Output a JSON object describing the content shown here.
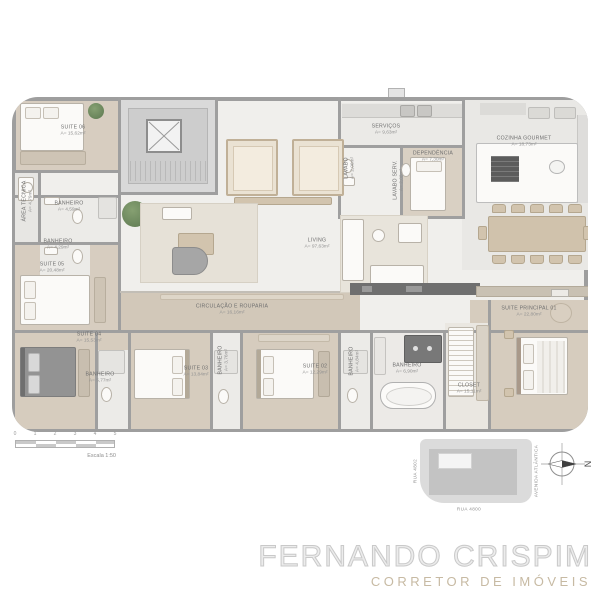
{
  "watermark": {
    "line1": "FERNANDO CRISPIM",
    "line2": "CORRETOR DE IMÓVEIS"
  },
  "scale_bar": {
    "ticks": [
      "0",
      "1",
      "2",
      "3",
      "4",
      "5"
    ],
    "label": "Escala 1:50"
  },
  "compass": {
    "north": "N"
  },
  "site_plan": {
    "street_left": "RUA 4802",
    "street_bottom": "RUA 4800",
    "street_right": "AVENIDA ATLÂNTICA"
  },
  "rooms": {
    "suite06": {
      "name": "SUITE 06",
      "area": "A= 15,62m²"
    },
    "area_tecnica": {
      "name": "ÁREA TÉCNICA",
      "area": "A= 4,79m²"
    },
    "banheiro_suite06": {
      "name": "BANHEIRO",
      "area": "A= 4,59m²"
    },
    "banheiro_suite05": {
      "name": "BANHEIRO",
      "area": "A= 4,29m²"
    },
    "suite05": {
      "name": "SUITE 05",
      "area": "A= 20,48m²"
    },
    "servicos": {
      "name": "SERVIÇOS",
      "area": "A= 9,63m²"
    },
    "lavabo": {
      "name": "LAVABO",
      "area": "A= 2,06m²"
    },
    "lavabo_serv": {
      "name": "LAVABO SERV.",
      "area": "A= 2,08m²"
    },
    "dependencia": {
      "name": "DEPENDÊNCIA",
      "area": "A= 7,30m²"
    },
    "cozinha_gourmet": {
      "name": "COZINHA GOURMET",
      "area": "A= 18,73m²"
    },
    "living": {
      "name": "LIVING",
      "area": "A= 97,63m²"
    },
    "circulacao": {
      "name": "CIRCULAÇÃO E ROUPARIA",
      "area": "A= 16,16m²"
    },
    "suite04": {
      "name": "SUITE 04",
      "area": "A= 15,53m²"
    },
    "banheiro_suite04": {
      "name": "BANHEIRO",
      "area": "A= 5,77m²"
    },
    "suite03": {
      "name": "SUITE 03",
      "area": "A= 13,84m²"
    },
    "banheiro_suite03": {
      "name": "BANHEIRO",
      "area": "A= 3,76m²"
    },
    "suite02": {
      "name": "SUITE 02",
      "area": "A= 12,29m²"
    },
    "banheiro_suite02": {
      "name": "BANHEIRO",
      "area": "A= 4,84m²"
    },
    "banheiro_principal": {
      "name": "BANHEIRO",
      "area": "A= 6,90m²"
    },
    "closet": {
      "name": "CLOSET",
      "area": "A= 15,11m²"
    },
    "suite_principal": {
      "name": "SUITE PRINCIPAL 01",
      "area": "A= 22,80m²"
    }
  },
  "colors": {
    "wall": "#9e9e9e",
    "wood_floor": "#d6ccbe",
    "light_floor": "#f0efec",
    "core_gray": "#d9d9d9",
    "dark_counter": "#6f6f6f",
    "plant_green": "#5c7850",
    "watermark_outline": "#c9c9c9",
    "watermark_tan": "#c7baa3"
  }
}
